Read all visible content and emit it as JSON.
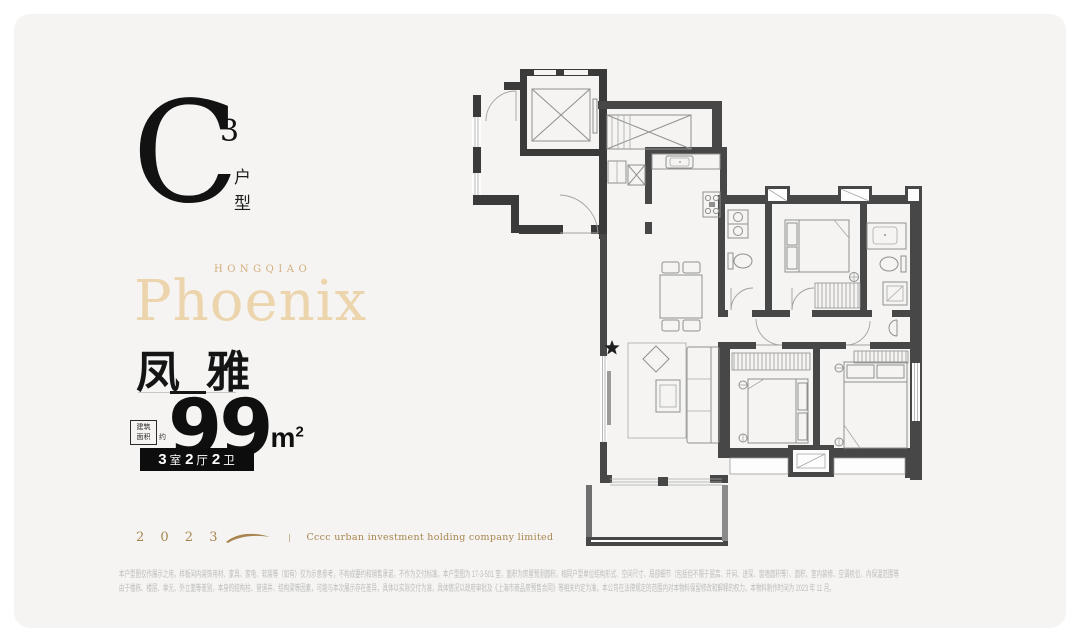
{
  "colors": {
    "card_bg": "#f5f4f2",
    "ink": "#1b1b1b",
    "gold_light": "#ecd4ac",
    "gold_mid": "#d3ae7e",
    "gold_dark": "#a8854f",
    "badge_bg": "#0d0d0d",
    "disclaimer": "#bdbdbd",
    "wall": "#474747",
    "furniture": "#8f8f8f"
  },
  "unit_logo": {
    "letter": "C",
    "superscript": "3",
    "type_vertical": "户型"
  },
  "brand": {
    "kicker": "HONGQIAO",
    "name": "Phoenix",
    "cn_name": "凤雅"
  },
  "area": {
    "label_line1": "建筑",
    "label_line2": "面积",
    "label_suffix": "约",
    "value": "99",
    "unit": "m",
    "unit_sup": "2"
  },
  "spec_badge": {
    "rooms_num": "3",
    "rooms_cn": "室",
    "halls_num": "2",
    "halls_cn": "厅",
    "baths_num": "2",
    "baths_cn": "卫"
  },
  "footer": {
    "year": "2 0 2 3",
    "company": "Cccc urban investment holding company limited"
  },
  "disclaimer": {
    "line1": "本户型图仅作展示之用，样板间内装饰用材、家具、家电、软装等（如有）仅为示意参考，不构成要约和销售承诺，不作为交付标准。本户型图为 17-3-501 室，面积为房屋预测面积，相同户型单位结构形式、空间尺寸、局部细节（包括但不限于层高、开间、进深、窗墙面积等）、面积、室内装修、空调机位、内保温范围等",
    "line2": "由于楼栋、楼层、单元、外立面等差别，本身的结构柱、管道井、结构梁等因素，可能与本次展示存在差异，具体以实际交付为准，具体情况以政府审批及《上海市商品房预售合同》等相关约定为准。本公司在法律规定的范围内对本物料保留修改和解释的权力。本物料制作时间为 2023 年 11 月。"
  }
}
